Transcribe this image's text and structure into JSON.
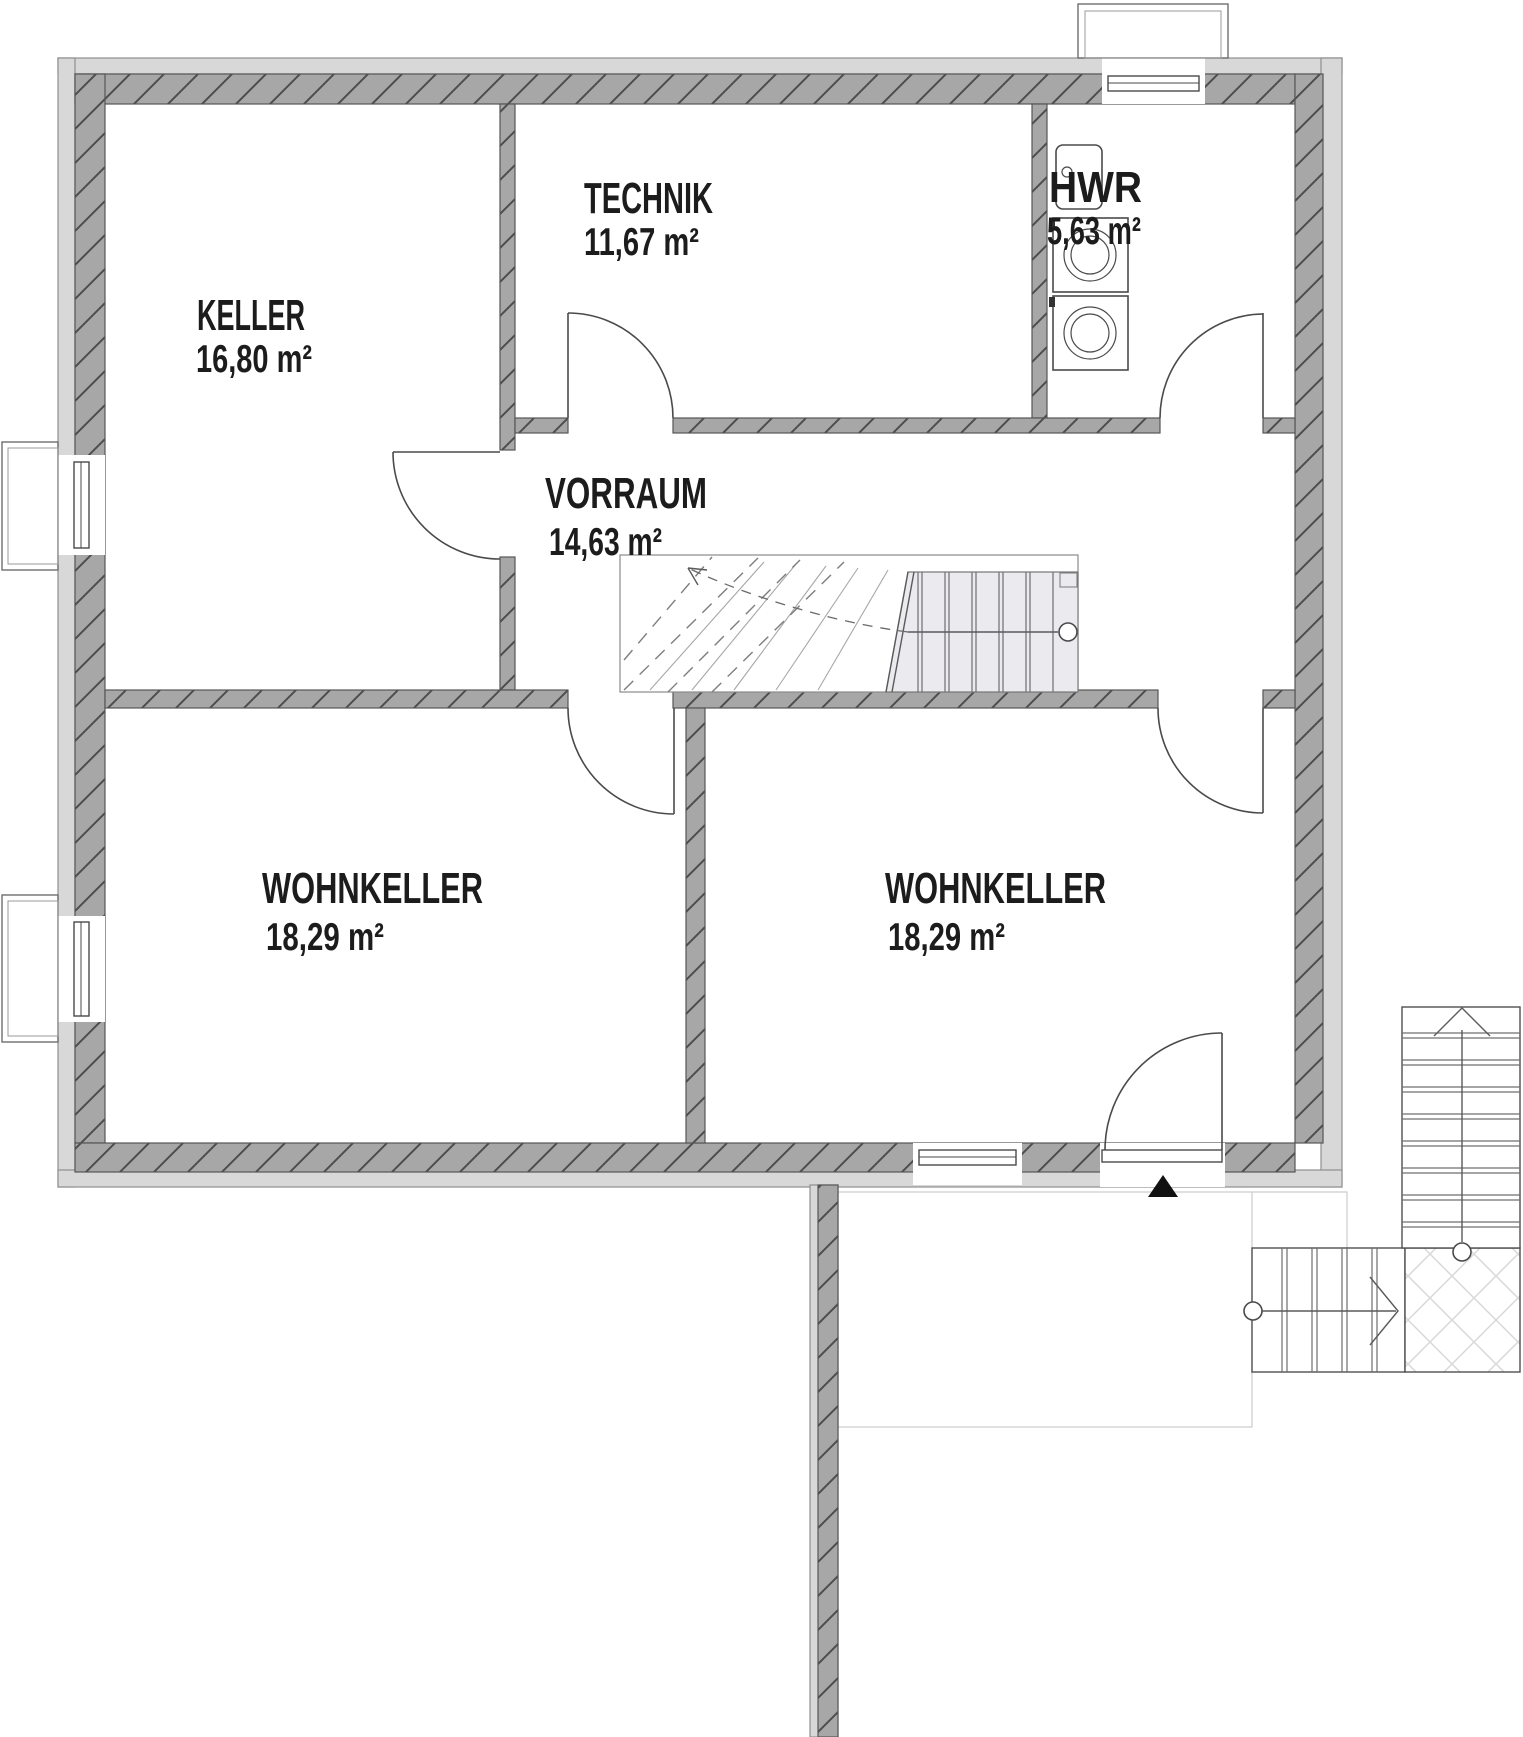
{
  "plan": {
    "rooms": [
      {
        "name": "KELLER",
        "area": "16,80 m²"
      },
      {
        "name": "TECHNIK",
        "area": "11,67 m²"
      },
      {
        "name": "HWR",
        "area": "5,63 m²"
      },
      {
        "name": "VORRAUM",
        "area": "14,63 m²"
      },
      {
        "name": "WOHNKELLER",
        "area": "18,29 m²"
      },
      {
        "name": "WOHNKELLER",
        "area": "18,29 m²"
      }
    ],
    "colors": {
      "wall_fill": "#a7a7a7",
      "wall_hatch_line": "#4d4d4d",
      "insulation_band": "#d8d8d8",
      "stair_fill": "#ebebef",
      "drawing_line": "#4a4a4a",
      "text": "#1c1c1c"
    }
  }
}
